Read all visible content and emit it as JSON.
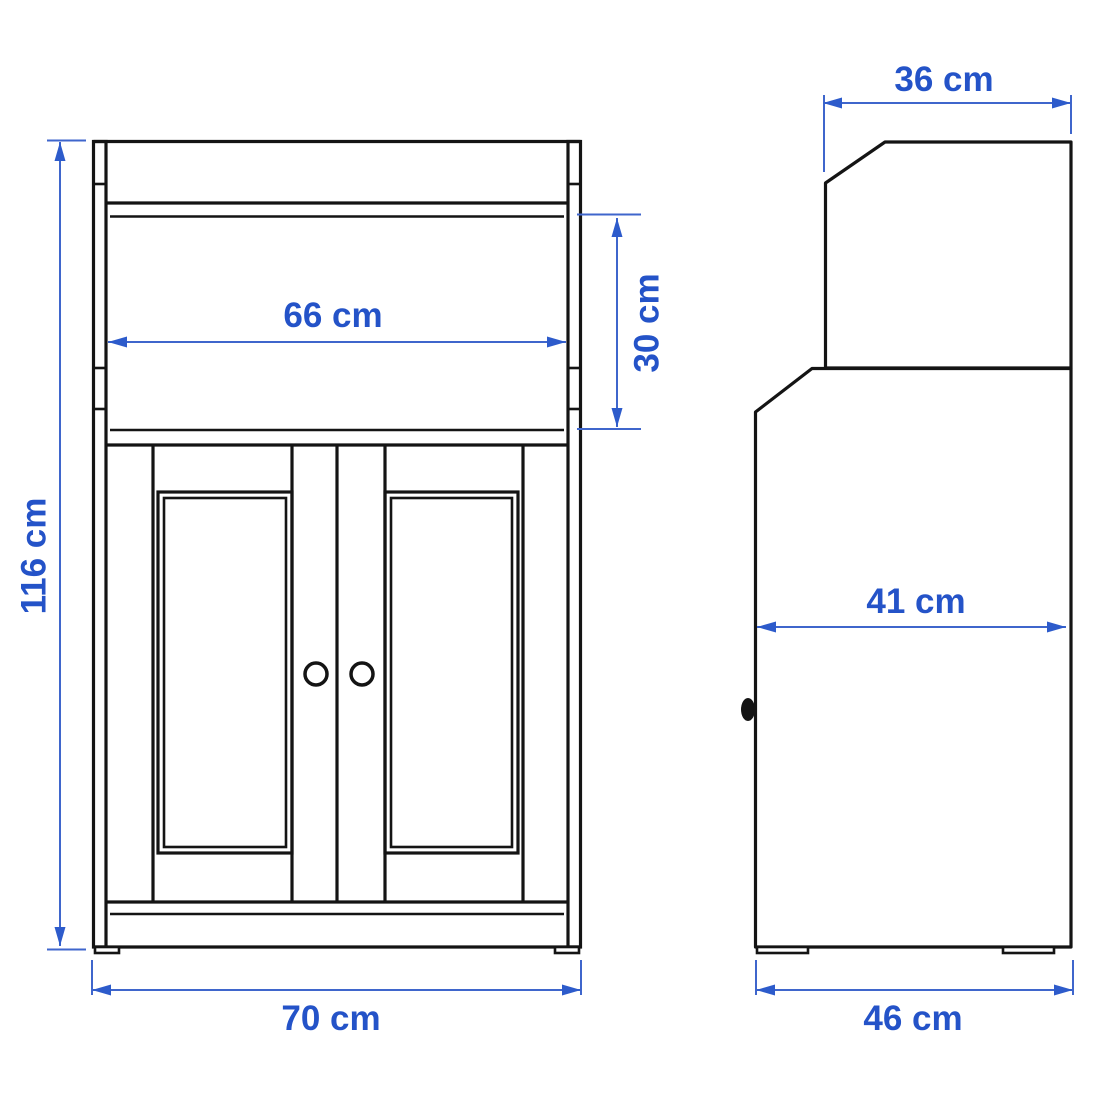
{
  "diagram": {
    "type": "furniture-dimension-drawing",
    "subject": "cabinet with two doors and open shelf",
    "views": {
      "front": {
        "label": "front view",
        "dims": {
          "height": "116 cm",
          "overall_width": "70 cm",
          "inner_width": "66 cm",
          "opening_height": "30 cm"
        }
      },
      "side": {
        "label": "side view",
        "dims": {
          "top_depth": "36 cm",
          "mid_depth": "41 cm",
          "base_depth": "46 cm"
        }
      }
    },
    "colors": {
      "outline": "#141414",
      "dimension_line": "#3f66cc",
      "dimension_text": "#2453c8",
      "background": "#ffffff"
    }
  }
}
